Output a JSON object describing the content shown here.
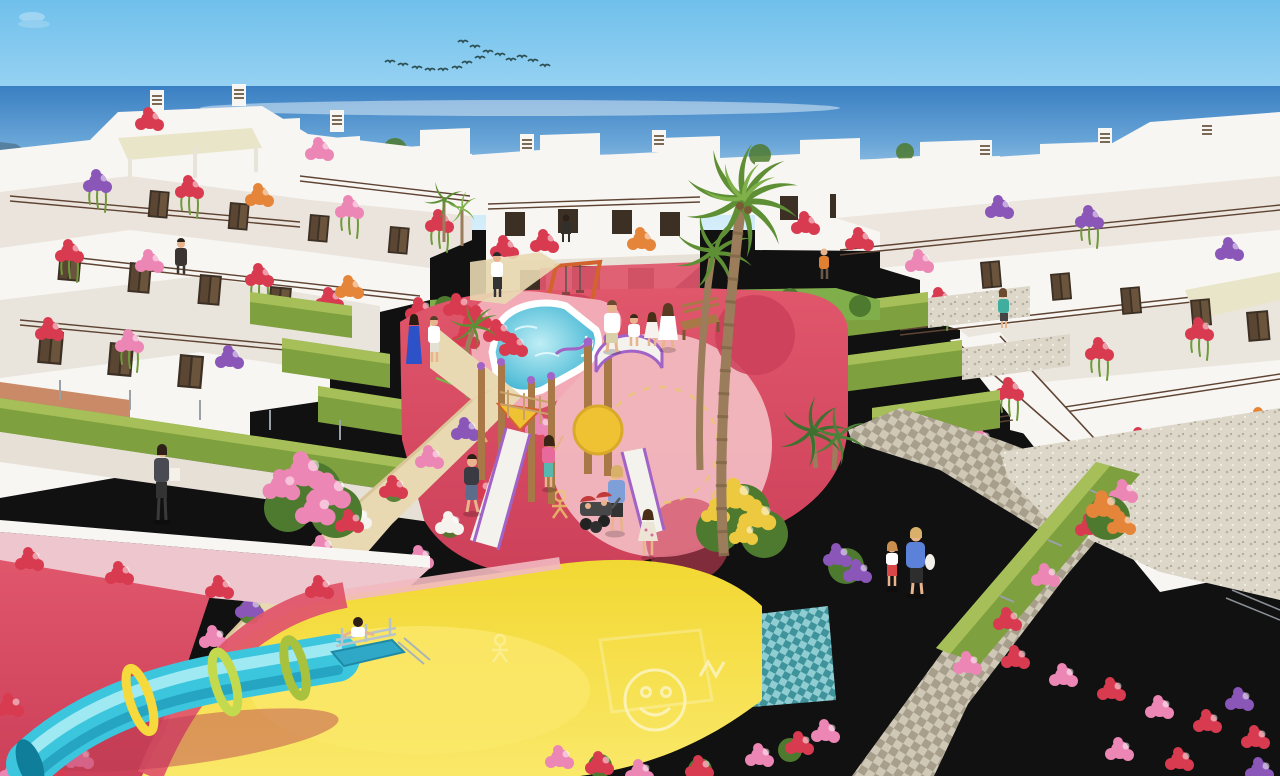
{
  "image": {
    "alt": "Aerial 3D architectural render of a white Mediterranean seaside apartment complex with roof terraces and flower boxes, hedge-lined sandy paths, a turquoise free-form communal pool, a children's playground with slides, a blue tube slide on a yellow play surface, palm trees, a flock of birds and residents strolling."
  },
  "scene": {
    "sky": "clear blue sky",
    "birds": "flock of birds",
    "sea": "sea horizon",
    "island": "headland on horizon",
    "buildings_left": "white terraced apartments with flower boxes",
    "buildings_center": "two-storey white apartment block",
    "buildings_right": "white terraced apartments with stairs and awning",
    "pool": "turquoise free-form pool with white rim and pink deck",
    "playground": "children's playground on red rubber surface",
    "tube_slide": "blue tube slide with yellow and green rings",
    "yellow_area": "yellow play surface with white stencil art",
    "paths": "sandy and cobbled garden paths with flower borders",
    "palms": "palm trees",
    "people": "residents and children"
  },
  "palette": {
    "sky_top": "#6fc0ec",
    "sky_bottom": "#d6eefb",
    "sea_deep": "#3a7fc2",
    "sea_mid": "#6aa6d8",
    "sea_light": "#aed4ea",
    "island": "#56809f",
    "bird": "#2c4f52",
    "building_white": "#f8f6f2",
    "building_shade": "#e7e0d6",
    "building_dark": "#d9d2c6",
    "terracotta": "#c47e58",
    "window_dark": "#3c2f24",
    "shutter": "#6b5138",
    "rail_brown": "#5f4434",
    "awning": "#e9e5c9",
    "hedge": "#7fa03e",
    "hedge_top": "#a6bf58",
    "lawn": "#7fae4a",
    "bush_dark": "#4d7a2e",
    "palm_trunk": "#9b7d5b",
    "palm_frond": "#5e8f35",
    "palm_frond_light": "#7fb04a",
    "pool_deck": "#f2abb6",
    "pool_edge": "#bfeef5",
    "pool_deep": "#1fa6c9",
    "rubber_red": "#e0566b",
    "rubber_dark": "#cc4059",
    "rubber_salmon": "#f2b9c0",
    "stencil_yellow": "#eac86a",
    "sand": "#e9d9b3",
    "sand_shade": "#d9c598",
    "cobble_light": "#cfc8b6",
    "cobble_dark": "#a79f8c",
    "gravel": "#dcd7c9",
    "mosaic_teal": "#3f939b",
    "mosaic_light": "#8fcdd2",
    "flower_red": "#d83a50",
    "flower_pink": "#ec86b5",
    "flower_purple": "#8a56b8",
    "flower_orange": "#e5853a",
    "flower_yellow": "#ecc93e",
    "flower_white": "#f6f3ee",
    "vine": "#6f9a3c",
    "tube_blue": "#3cc6de",
    "tube_shade": "#1f9cba",
    "tube_light": "#a8ecf4",
    "ring_yellow": "#f6d93c",
    "ring_green": "#c3da4e",
    "wood": "#a87947",
    "equip_purple": "#a263c6",
    "equip_orange": "#d2622e",
    "equip_yellow": "#efc233",
    "slide_white": "#f4f2ed",
    "wall_pink": "#eec6cd",
    "ground_yellow": "#f2d832",
    "ground_yellow_light": "#fae869",
    "skin": "#e8b48e"
  }
}
